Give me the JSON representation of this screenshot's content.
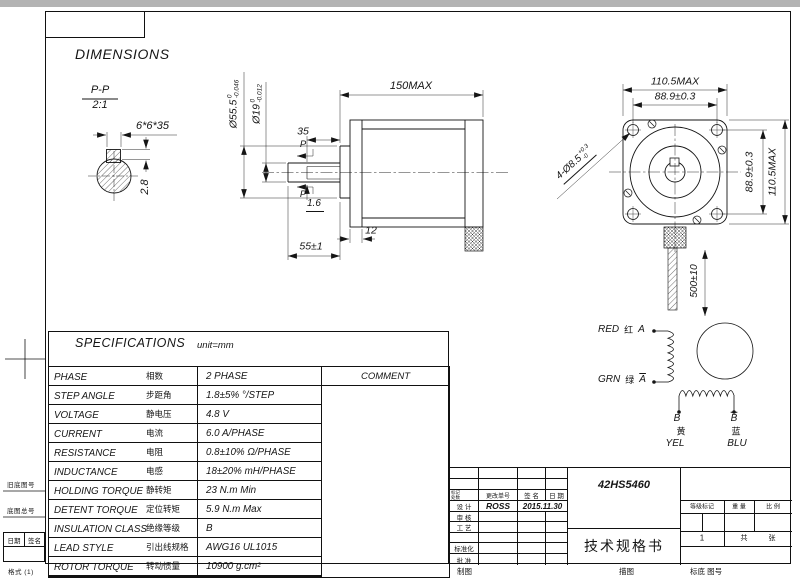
{
  "frame": {
    "model": "42HS5460",
    "doc_title": "技术规格书",
    "footer_labels": [
      "制图",
      "描图",
      "标底 图号"
    ],
    "margin": {
      "old_drawing_no": "旧底图号",
      "base_drawing_no": "底图总号",
      "date": "日期",
      "sign": "签名",
      "format": "格式 (1)"
    }
  },
  "headings": {
    "dimensions": "DIMENSIONS",
    "specifications": "SPECIFICATIONS",
    "unit": "unit=mm"
  },
  "detail_view": {
    "section": "P-P",
    "scale": "2:1",
    "key": "6*6*35",
    "key_height": "2.8"
  },
  "side_view": {
    "total_length": "150MAX",
    "pilot_dia": {
      "main": "Ø55.5",
      "upper": "0",
      "lower": "-0.046"
    },
    "shaft_dia": {
      "main": "Ø19",
      "upper": "0",
      "lower": "-0.012"
    },
    "key_length": "35",
    "section_mark": "P",
    "key_depth": "1.6",
    "flange_thickness": "12",
    "shaft_length": "55±1"
  },
  "front_view": {
    "width": "110.5MAX",
    "hole_pitch_h": "88.9±0.3",
    "hole_pitch_v": "88.9±0.3",
    "height": "110.5MAX",
    "mount_holes": {
      "main": "4-Ø8.5",
      "upper": "+0.3",
      "lower": "-0"
    },
    "lead_length": "500±10"
  },
  "wiring": {
    "red": "RED",
    "red_cn": "红",
    "phase_a": "A",
    "grn": "GRN",
    "grn_cn": "绿",
    "phase_a_bar": "A",
    "phase_b": "B",
    "phase_b_bar": "B",
    "yel_cn": "黄",
    "yel": "YEL",
    "blu_cn": "蓝",
    "blu": "BLU"
  },
  "spec_table": {
    "comment_header": "COMMENT",
    "rows": [
      {
        "en": "PHASE",
        "cn": "相数",
        "value": "2 PHASE"
      },
      {
        "en": "STEP ANGLE",
        "cn": "步距角",
        "value": "1.8±5% °/STEP"
      },
      {
        "en": "VOLTAGE",
        "cn": "静电压",
        "value": "4.8 V"
      },
      {
        "en": "CURRENT",
        "cn": "电流",
        "value": "6.0 A/PHASE"
      },
      {
        "en": "RESISTANCE",
        "cn": "电阻",
        "value": "0.8±10% Ω/PHASE"
      },
      {
        "en": "INDUCTANCE",
        "cn": "电感",
        "value": "18±20% mH/PHASE"
      },
      {
        "en": "HOLDING TORQUE",
        "cn": "静转矩",
        "value": "23 N.m Min"
      },
      {
        "en": "DETENT TORQUE",
        "cn": "定位转矩",
        "value": "5.9 N.m Max"
      },
      {
        "en": "INSULATION CLASS",
        "cn": "绝缘等级",
        "value": "B"
      },
      {
        "en": "LEAD STYLE",
        "cn": "引出线规格",
        "value": "AWG16 UL1015"
      },
      {
        "en": "ROTOR TORQUE",
        "cn": "转动惯量",
        "value": "10900 g.cm²"
      }
    ]
  },
  "title_block": {
    "change_header": {
      "mark": "标记",
      "count": "处数",
      "order": "更改单号",
      "sign": "签 名",
      "date": "日 期"
    },
    "rows": [
      {
        "label": "设 计",
        "name": "ROSS",
        "date": "2015.11.30"
      },
      {
        "label": "审 核"
      },
      {
        "label": "工 艺"
      },
      {
        "label": "标准化"
      },
      {
        "label": "批 准"
      }
    ],
    "grade_mark": "等级标记",
    "weight": "重 量",
    "scale": "比 例",
    "sheet_no": "1",
    "sheet_total": "共",
    "sheet_unit": "张"
  }
}
